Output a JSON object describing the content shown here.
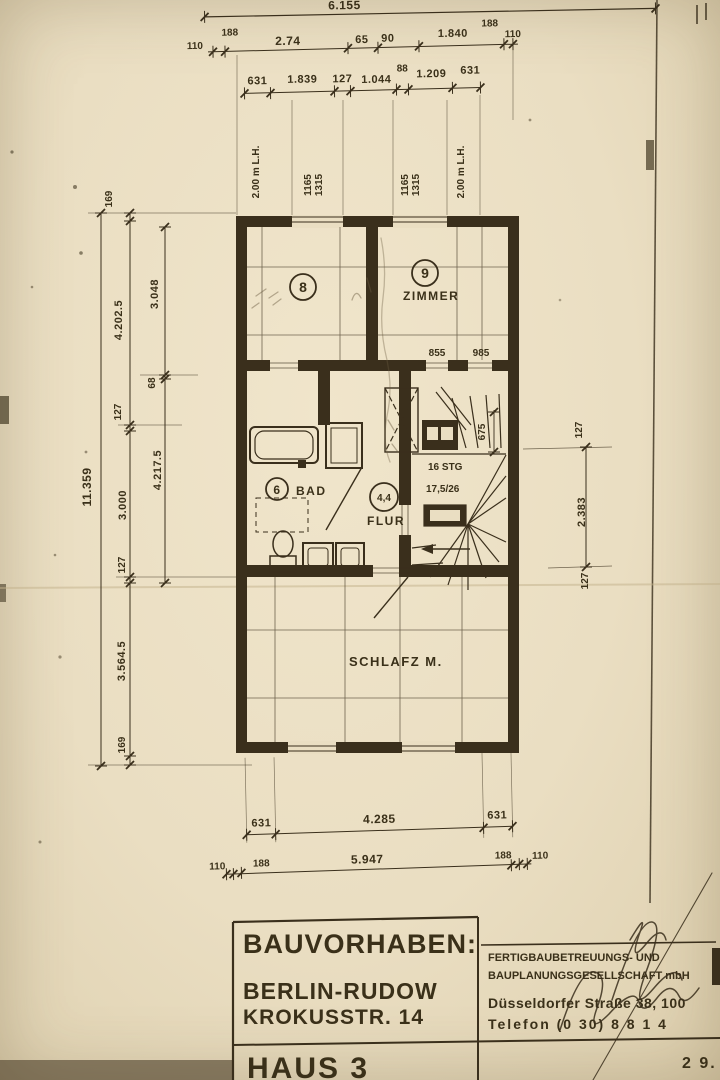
{
  "colors": {
    "paper": "#eadec2",
    "ink": "#3a2f1c"
  },
  "top_dims": {
    "total": "6.155",
    "row2": [
      "110",
      "188",
      "2.74",
      "65",
      "90",
      "1.840",
      "188",
      "110"
    ],
    "row3": [
      "631",
      "1.839",
      "127",
      "1.044",
      "88",
      "1.209",
      "631"
    ]
  },
  "window_annotations": {
    "left_lh": "2.00 m L.H.",
    "right_lh": "2.00 m L.H.",
    "win1_w": "1165",
    "win1_h": "1315",
    "win2_w": "1165",
    "win2_h": "1315"
  },
  "left_dims": {
    "overall": "11.359",
    "chain": [
      "169",
      "4.202.5",
      "127",
      "3.000",
      "127",
      "3.564.5",
      "169"
    ],
    "inner": [
      "3.048",
      "68",
      "4.217.5"
    ]
  },
  "right_dims": [
    "127",
    "2.383",
    "127"
  ],
  "bottom_dims": {
    "row1": [
      "631",
      "4.285",
      "631"
    ],
    "row2": [
      "110",
      "188",
      "5.947",
      "188",
      "110"
    ]
  },
  "rooms": {
    "room8_no": "8",
    "room9_no": "9",
    "room9_name": "ZIMMER",
    "bad_no": "6",
    "bad_name": "BAD",
    "flur_no": "4,4",
    "flur_name": "FLUR",
    "schlafzimmer": "SCHLAFZ M."
  },
  "plan_annotations": {
    "sill1": "855",
    "sill2": "985",
    "shaft_dim": "675",
    "stair_line1": "16 STG",
    "stair_line2": "17,5/26"
  },
  "title_block": {
    "project_label": "BAUVORHABEN:",
    "city": "BERLIN-RUDOW",
    "street": "KROKUSSTR. 14",
    "house": "HAUS 3",
    "company_line1": "FERTIGBAUBETREUUNGS- UND",
    "company_line2": "BAUPLANUNGSGESELLSCHAFT mbH",
    "address": "Düsseldorfer Straße 38, 100",
    "phone": "Telefon (0 30) 8 8 1 4",
    "date": "2 9."
  }
}
